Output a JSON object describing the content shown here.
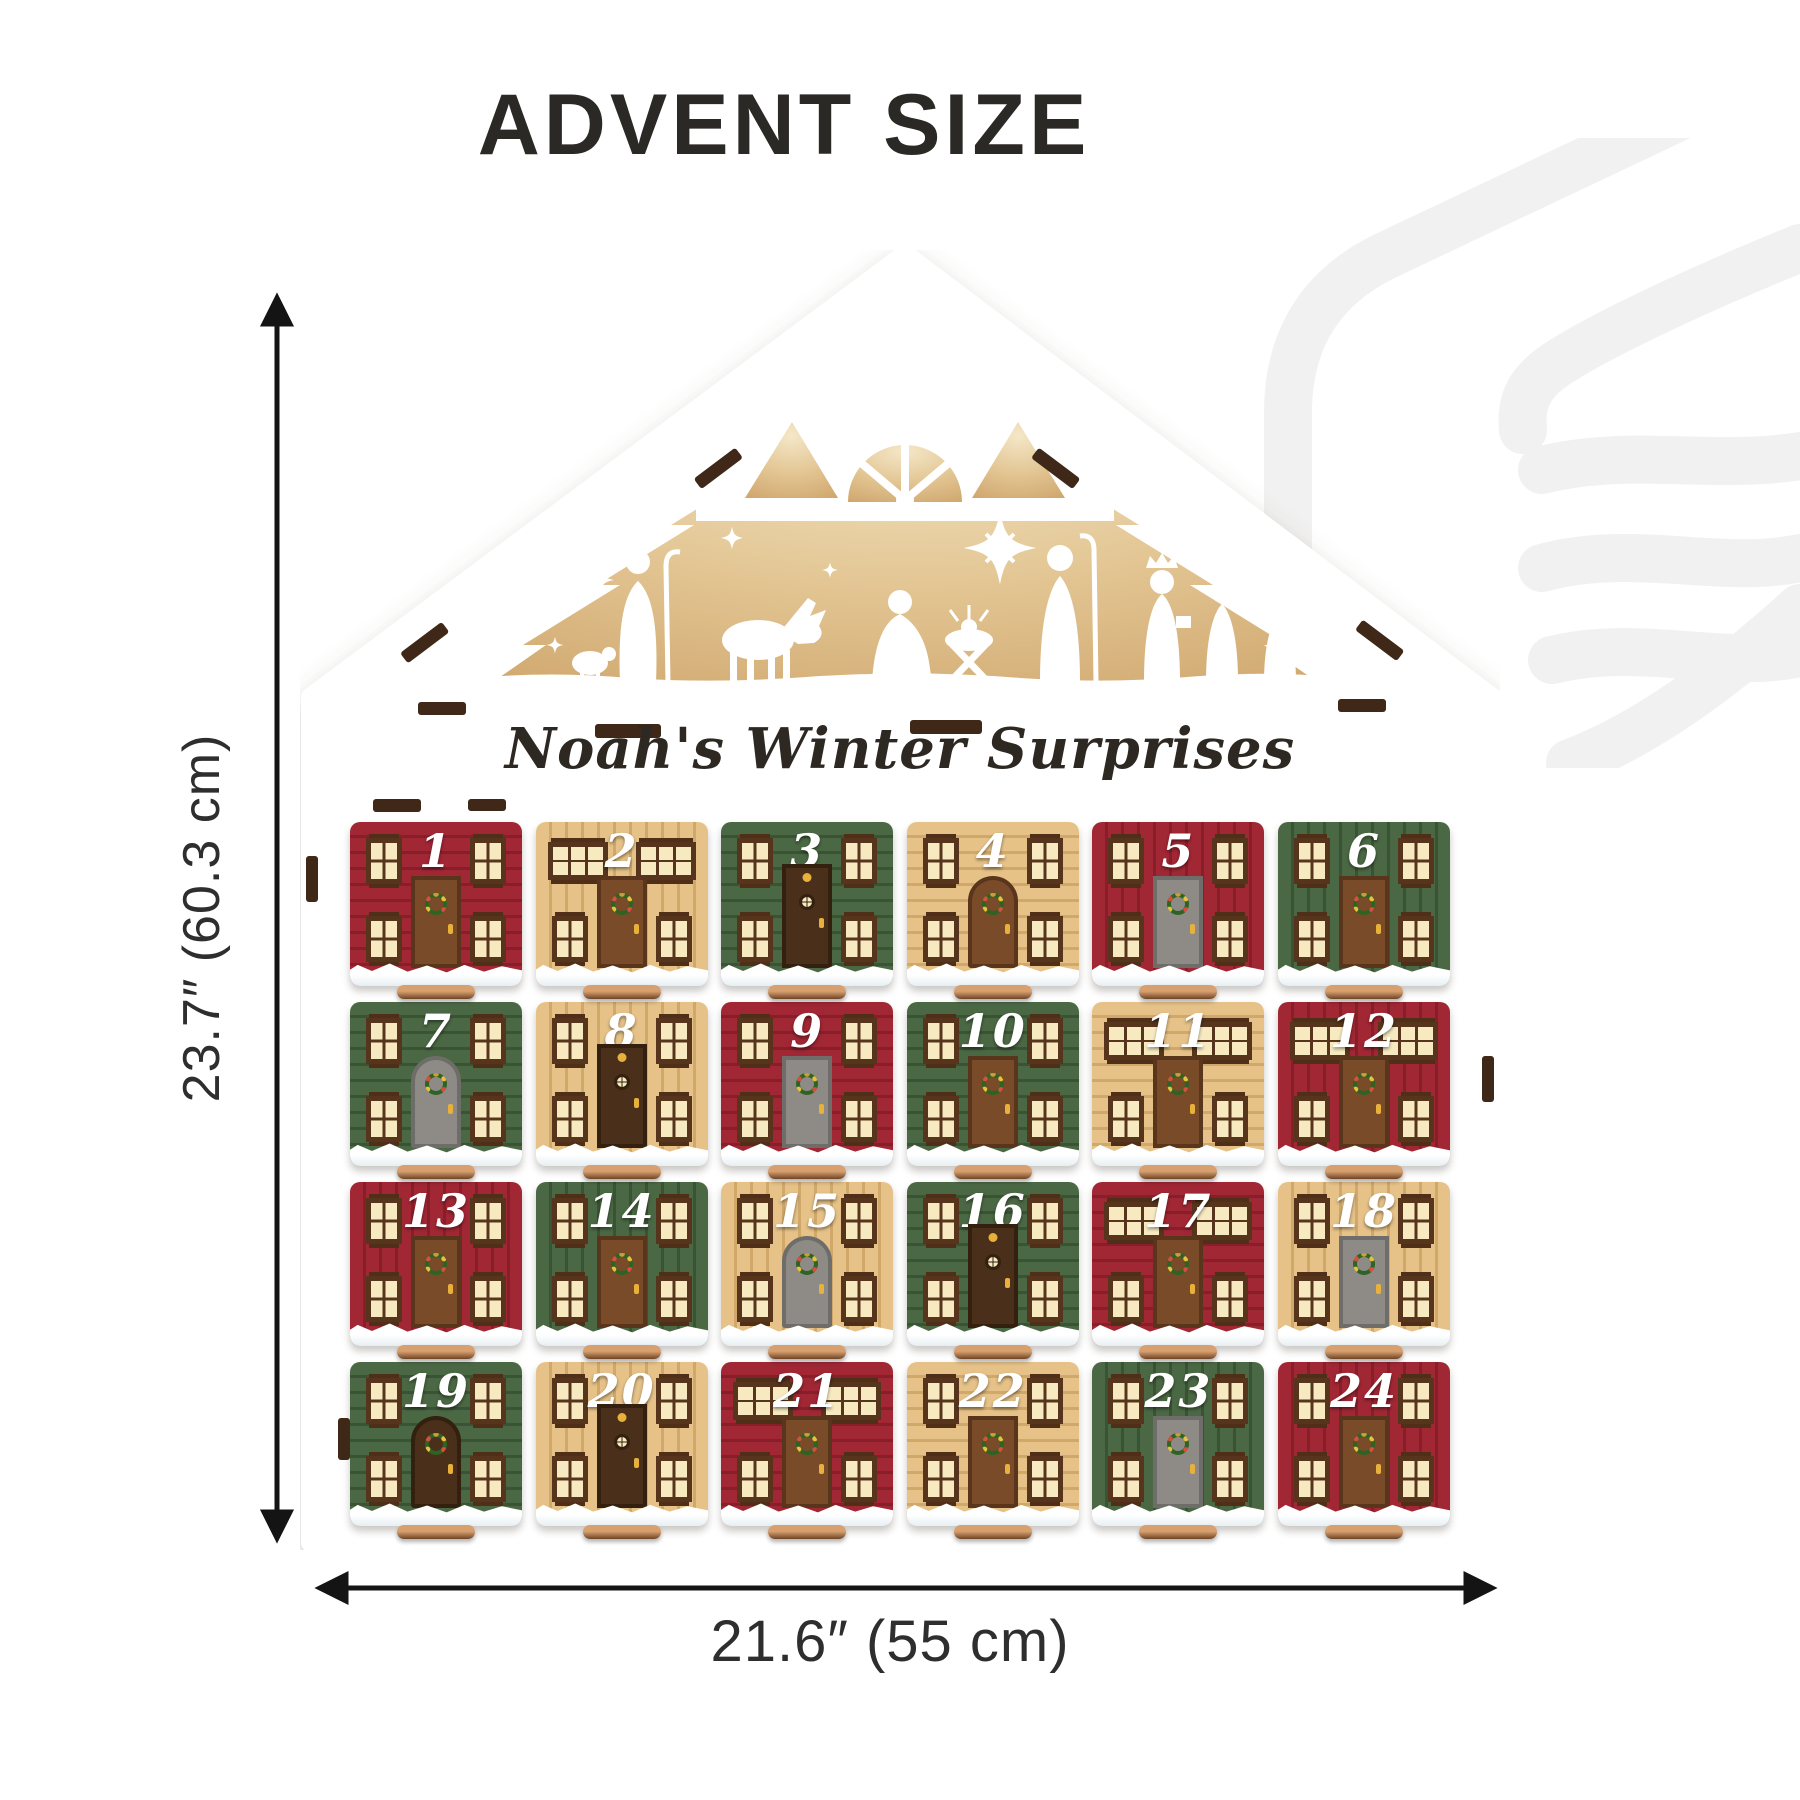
{
  "header": {
    "title": "ADVENT SIZE"
  },
  "calendar": {
    "plaque": "Noah's Winter Surprises",
    "boxes": [
      {
        "number": "1",
        "color": "red",
        "stripes": "h",
        "windows": "std",
        "door": "brown",
        "door_shape": "rect",
        "ornament": "wreath"
      },
      {
        "number": "2",
        "color": "tan",
        "stripes": "v",
        "windows": "wide",
        "door": "brown",
        "door_shape": "rect",
        "ornament": "wreath"
      },
      {
        "number": "3",
        "color": "green",
        "stripes": "h",
        "windows": "std",
        "door": "dark",
        "door_shape": "tall",
        "ornament": "bell"
      },
      {
        "number": "4",
        "color": "tan",
        "stripes": "h",
        "windows": "std",
        "door": "brown",
        "door_shape": "arch",
        "ornament": "wreath"
      },
      {
        "number": "5",
        "color": "red",
        "stripes": "v",
        "windows": "std",
        "door": "gray",
        "door_shape": "rect",
        "ornament": "wreath"
      },
      {
        "number": "6",
        "color": "green",
        "stripes": "v",
        "windows": "std",
        "door": "brown",
        "door_shape": "rect",
        "ornament": "wreath"
      },
      {
        "number": "7",
        "color": "green",
        "stripes": "h",
        "windows": "std",
        "door": "gray",
        "door_shape": "arch",
        "ornament": "wreath"
      },
      {
        "number": "8",
        "color": "tan",
        "stripes": "v",
        "windows": "std",
        "door": "dark",
        "door_shape": "tall",
        "ornament": "bell"
      },
      {
        "number": "9",
        "color": "red",
        "stripes": "h",
        "windows": "std",
        "door": "gray",
        "door_shape": "rect",
        "ornament": "wreath"
      },
      {
        "number": "10",
        "color": "green",
        "stripes": "h",
        "windows": "std",
        "door": "brown",
        "door_shape": "rect",
        "ornament": "wreath"
      },
      {
        "number": "11",
        "color": "tan",
        "stripes": "h",
        "windows": "wide",
        "door": "brown",
        "door_shape": "rect",
        "ornament": "wreath"
      },
      {
        "number": "12",
        "color": "red",
        "stripes": "v",
        "windows": "wide",
        "door": "brown",
        "door_shape": "rect",
        "ornament": "wreath"
      },
      {
        "number": "13",
        "color": "red",
        "stripes": "v",
        "windows": "std",
        "door": "brown",
        "door_shape": "rect",
        "ornament": "wreath"
      },
      {
        "number": "14",
        "color": "green",
        "stripes": "v",
        "windows": "std",
        "door": "brown",
        "door_shape": "rect",
        "ornament": "wreath"
      },
      {
        "number": "15",
        "color": "tan",
        "stripes": "v",
        "windows": "std",
        "door": "gray",
        "door_shape": "arch",
        "ornament": "wreath"
      },
      {
        "number": "16",
        "color": "green",
        "stripes": "h",
        "windows": "std",
        "door": "dark",
        "door_shape": "tall",
        "ornament": "bell"
      },
      {
        "number": "17",
        "color": "red",
        "stripes": "h",
        "windows": "wide",
        "door": "brown",
        "door_shape": "rect",
        "ornament": "wreath"
      },
      {
        "number": "18",
        "color": "tan",
        "stripes": "v",
        "windows": "std",
        "door": "gray",
        "door_shape": "rect",
        "ornament": "wreath"
      },
      {
        "number": "19",
        "color": "green",
        "stripes": "h",
        "windows": "std",
        "door": "dark",
        "door_shape": "arch",
        "ornament": "wreath"
      },
      {
        "number": "20",
        "color": "tan",
        "stripes": "v",
        "windows": "std",
        "door": "dark",
        "door_shape": "tall",
        "ornament": "bell"
      },
      {
        "number": "21",
        "color": "red",
        "stripes": "h",
        "windows": "wide",
        "door": "brown",
        "door_shape": "rect",
        "ornament": "wreath"
      },
      {
        "number": "22",
        "color": "tan",
        "stripes": "h",
        "windows": "std",
        "door": "brown",
        "door_shape": "rect",
        "ornament": "wreath"
      },
      {
        "number": "23",
        "color": "green",
        "stripes": "v",
        "windows": "std",
        "door": "gray",
        "door_shape": "rect",
        "ornament": "wreath"
      },
      {
        "number": "24",
        "color": "red",
        "stripes": "v",
        "windows": "std",
        "door": "brown",
        "door_shape": "rect",
        "ornament": "wreath"
      }
    ]
  },
  "dimensions": {
    "height_label": "23.7″ (60.3 cm)",
    "width_label": "21.6″ (55 cm)"
  },
  "colors": {
    "title-text": "#2b2926",
    "dimension-text": "#2e2e2e",
    "box-red": "#a12734",
    "box-red-stripe": "#871f2b",
    "box-tan": "#e6c288",
    "box-tan-stripe": "#cfa86a",
    "box-green": "#4b6844",
    "box-green-stripe": "#3a5334",
    "window-cream": "#f7eac1",
    "frame-brown": "#56351c",
    "door-brown": "#7a4b28",
    "door-dark": "#4a2f1a",
    "door-gray": "#8e8b86",
    "snow-shadow": "#dfe9f0",
    "wood-slot": "#3f2817",
    "backdrop-tan": "#e3c694",
    "wreath-green": "#2f6323",
    "gold": "#e7b13c"
  }
}
